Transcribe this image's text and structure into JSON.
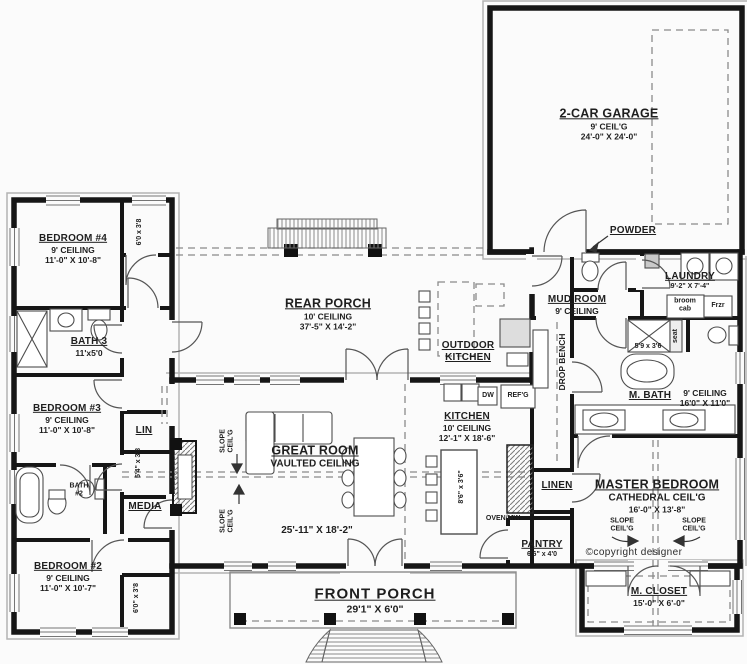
{
  "rooms": {
    "garage": {
      "name": "2-CAR GARAGE",
      "ceiling": "9' CEIL'G",
      "dims": "24'-0\" X 24'-0\""
    },
    "rear_porch": {
      "name": "REAR PORCH",
      "ceiling": "10' CEILING",
      "dims": "37'-5\" X 14'-2\""
    },
    "outdoor_kitchen": {
      "name_line1": "OUTDOOR",
      "name_line2": "KITCHEN"
    },
    "bedroom4": {
      "name": "BEDROOM #4",
      "ceiling": "9' CEILING",
      "dims": "11'-0\" X 10'-8\""
    },
    "bath3": {
      "name": "BATH 3",
      "dims": "11'x5'0"
    },
    "bedroom3": {
      "name": "BEDROOM #3",
      "ceiling": "9' CEILING",
      "dims": "11'-0\" X 10'-8\""
    },
    "lin": {
      "name": "LIN"
    },
    "bath2": {
      "name_line1": "BATH",
      "name_line2": "#2"
    },
    "media": {
      "name": "MEDIA"
    },
    "bedroom2": {
      "name": "BEDROOM #2",
      "ceiling": "9' CEILING",
      "dims": "11'-0\" X 10'-7\""
    },
    "great_room": {
      "name": "GREAT ROOM",
      "ceiling": "VAULTED CEILING",
      "dims": "25'-11\" X 18'-2\""
    },
    "kitchen": {
      "name": "KITCHEN",
      "ceiling": "10' CEILING",
      "dims": "12'-1\" X 18'-6\""
    },
    "pantry": {
      "name": "PANTRY",
      "dims": "6'6\" x 4'0"
    },
    "mud_room": {
      "name": "MUD ROOM",
      "ceiling": "9' CEILING"
    },
    "powder": {
      "name": "POWDER"
    },
    "laundry": {
      "name": "LAUNDRY",
      "dims": "9'-2\" X 7'-4\""
    },
    "master_bath": {
      "name": "M. BATH",
      "ceiling": "9' CEILING",
      "dims": "16'0\" X 11'0\""
    },
    "linen": {
      "name": "LINEN"
    },
    "master_bedroom": {
      "name": "MASTER BEDROOM",
      "ceiling": "CATHEDRAL CEIL'G",
      "dims": "16'-0\" X 13'-8\""
    },
    "master_closet": {
      "name": "M. CLOSET",
      "dims": "15'-0\" X 6'-0\""
    },
    "front_porch": {
      "name": "FRONT PORCH",
      "dims": "29'1\" X 6'0\""
    }
  },
  "annotations": {
    "closet_bedroom4": "6'0 x 3'8",
    "closet_bedroom3": "5'4\" x 3'8",
    "closet_bedroom2": "6'0\" x 3'8",
    "kitchen_island": "8'6\" x 3'6\"",
    "master_shower": "5'9 x 3'6",
    "shower_seat": "seat",
    "drop_bench": "DROP BENCH",
    "broom_cab_line1": "broom",
    "broom_cab_line2": "cab",
    "freezer": "Frzr",
    "fridge": "REF'G",
    "dishwasher": "DW",
    "oven_microwave": "OVEN/MW",
    "slope_line1": "SLOPE",
    "slope_line2": "CEIL'G",
    "copyright": "©copyright designer"
  }
}
